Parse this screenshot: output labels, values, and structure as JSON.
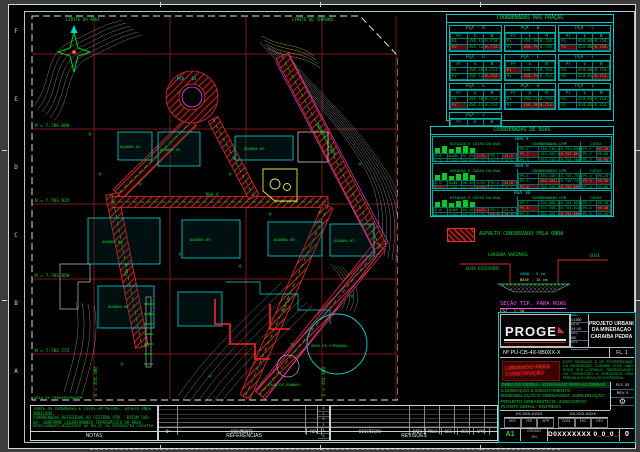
{
  "frame": {
    "row_letters": [
      "F",
      "E",
      "D",
      "C",
      "B",
      "A"
    ]
  },
  "map": {
    "labels": [
      {
        "t": "LIMITE DA ÁREA",
        "x": 36,
        "y": 7,
        "c": "#00dd33",
        "s": 4
      },
      {
        "t": "LIMITE DO TERRENO",
        "x": 262,
        "y": 7,
        "c": "#00dd33",
        "s": 4
      },
      {
        "t": "PÇA - 01",
        "x": 147,
        "y": 66,
        "c": "#00e0e0",
        "s": 4
      },
      {
        "t": "QUADRA 01",
        "x": 90,
        "y": 134,
        "c": "#00dd33",
        "s": 3.8
      },
      {
        "t": "QUADRA 02",
        "x": 130,
        "y": 137,
        "c": "#00dd33",
        "s": 3.8
      },
      {
        "t": "QUADRA 03",
        "x": 214,
        "y": 136,
        "c": "#00dd33",
        "s": 3.8
      },
      {
        "t": "QUADRA 04",
        "x": 72,
        "y": 229,
        "c": "#00dd33",
        "s": 3.8
      },
      {
        "t": "QUADRA 05",
        "x": 160,
        "y": 227,
        "c": "#00dd33",
        "s": 3.8
      },
      {
        "t": "QUADRA 06",
        "x": 244,
        "y": 227,
        "c": "#00dd33",
        "s": 3.8
      },
      {
        "t": "QUADRA 07",
        "x": 304,
        "y": 228,
        "c": "#00dd33",
        "s": 3.8
      },
      {
        "t": "QUADRA 08",
        "x": 78,
        "y": 294,
        "c": "#00dd33",
        "s": 3.8
      },
      {
        "t": "RUA 4",
        "x": 176,
        "y": 182,
        "c": "#00dd33",
        "s": 4
      },
      {
        "t": "RUA 6",
        "x": 97,
        "y": 262,
        "c": "#00dd33",
        "s": 4,
        "r": -83
      },
      {
        "t": "RUA 10",
        "x": 254,
        "y": 298,
        "c": "#00dd33",
        "s": 4,
        "r": -64
      },
      {
        "t": "ESTRADA DA MINA",
        "x": 286,
        "y": 110,
        "c": "#00dd33",
        "s": 4,
        "r": 60
      },
      {
        "t": "ÁREA DE EXPANSÃO",
        "x": 281,
        "y": 333,
        "c": "#00dd33",
        "s": 3.8
      },
      {
        "t": "CASA DE BOMBAS",
        "x": 238,
        "y": 372,
        "c": "#00dd33",
        "s": 3.8
      },
      {
        "t": "ÁREA DE TERRAPLENAGEM",
        "x": 4,
        "y": 385,
        "c": "#00dd33",
        "s": 3.8
      },
      {
        "t": "N = 7.784.000",
        "x": 5,
        "y": 113,
        "c": "#00dd33",
        "s": 4.4
      },
      {
        "t": "N = 7.783.925",
        "x": 5,
        "y": 188,
        "c": "#00dd33",
        "s": 4.4
      },
      {
        "t": "N = 7.783.850",
        "x": 5,
        "y": 263,
        "c": "#00dd33",
        "s": 4.4
      },
      {
        "t": "N = 7.783.775",
        "x": 5,
        "y": 338,
        "c": "#00dd33",
        "s": 4.4
      },
      {
        "t": "E = 354.100",
        "x": 67,
        "y": 382,
        "c": "#00dd33",
        "s": 4.4,
        "r": -90
      },
      {
        "t": "E = 354.400",
        "x": 295,
        "y": 382,
        "c": "#00dd33",
        "s": 4.4,
        "r": -90
      }
    ]
  },
  "praca_tables": {
    "title": "COORDENADAS DAS PRAÇAS",
    "col_headers": [
      "PT",
      "E",
      "N"
    ],
    "tables": [
      {
        "name": "PÇA - A",
        "rows": [
          [
            "P1",
            "354.712,40",
            "8.754.061,22"
          ],
          [
            "!P2",
            "354.728,15",
            "!8.754.048,90"
          ]
        ]
      },
      {
        "name": "PÇA - B",
        "rows": [
          [
            "P1",
            "354.780,55",
            "8.754.070,18"
          ],
          [
            "P2",
            "!354.795,02",
            "8.754.055,60"
          ]
        ]
      },
      {
        "name": "PÇA - C",
        "rows": [
          [
            "P1",
            "354.848,12",
            "8.754.066,45"
          ],
          [
            "!P2",
            "354.861,77",
            "!8.754.050,23"
          ]
        ]
      },
      {
        "name": "PÇA - D",
        "rows": [
          [
            "P1",
            "354.706,88",
            "8.753.988,35"
          ],
          [
            "P2",
            "354.721,40",
            "!8.753.974,10"
          ]
        ]
      },
      {
        "name": "PÇA - E",
        "rows": [
          [
            "!P1",
            "354.775,30",
            "8.753.992,72"
          ],
          [
            "P2",
            "!354.790,11",
            "8.753.977,48"
          ]
        ]
      },
      {
        "name": "PÇA - F",
        "rows": [
          [
            "P1",
            "354.843,95",
            "8.753.985,06"
          ],
          [
            "P2",
            "354.858,60",
            "!8.753.970,84"
          ]
        ]
      },
      {
        "name": "PÇA - G",
        "rows": [
          [
            "P1",
            "354.702,17",
            "8.753.910,58"
          ],
          [
            "!P2",
            "354.716,93",
            "8.753.896,30"
          ]
        ]
      },
      {
        "name": "PÇA - H",
        "rows": [
          [
            "P1",
            "354.770,44",
            "8.753.905,12"
          ],
          [
            "P2",
            "!354.785,20",
            "!8.753.890,77"
          ]
        ]
      },
      {
        "name": "PÇA - I",
        "rows": [
          [
            "P1",
            "354.838,66",
            "8.753.902,40"
          ],
          [
            "P2",
            "354.853,33",
            "8.753.888,15"
          ]
        ]
      },
      {
        "name": "PÇA - J",
        "rows": [
          [
            "P1",
            "354.698,25",
            "8.753.830,90"
          ],
          [
            "!P2",
            "354.712,84",
            "!8.753.816,55"
          ]
        ]
      }
    ]
  },
  "ruas_block": {
    "title": "COORDENADAS DE RUAS",
    "sections": [
      {
        "name": "RUA 4",
        "left_title": "ESTACAS E COTAS DA RUA",
        "mid_title": "COORDENADAS UTM",
        "right_title": "COTAS",
        "left_rows": [
          [
            "E-0",
            "0+00",
            "97,45",
            "!i=2%",
            "PV-1",
            "!12,5"
          ],
          [
            "E-1",
            "1+00",
            "96,80",
            "i=2%",
            "PV-2",
            "14,0"
          ]
        ],
        "mid_rows": [
          [
            "PV-1",
            "354.210,45",
            "8.753.850,12"
          ],
          [
            "!PV-2",
            "354.265,80",
            "!8.753.801,34"
          ],
          [
            "PV-3",
            "354.310,22",
            "8.753.760,90"
          ]
        ],
        "right_rows": [
          [
            "PV-1",
            "!97,45"
          ],
          [
            "PV-2",
            "96,80"
          ],
          [
            "PV-3",
            "!95,95"
          ]
        ]
      },
      {
        "name": "RUA 6",
        "left_title": "ESTACAS E COTAS DA RUA",
        "mid_title": "COORDENADAS UTM",
        "right_title": "COTAS",
        "left_rows": [
          [
            "E-0",
            "0+00",
            "96,20",
            "i=3%",
            "PV-4",
            "!11,0"
          ],
          [
            "!E-1",
            "1+00",
            "95,55",
            "!i=3%",
            "PV-5",
            "13,5"
          ]
        ],
        "mid_rows": [
          [
            "PV-4",
            "354.158,72",
            "8.753.792,60"
          ],
          [
            "PV-5",
            "!354.204,18",
            "8.753.744,05"
          ],
          [
            "!PV-6",
            "354.250,63",
            "!8.753.698,41"
          ]
        ],
        "right_rows": [
          [
            "PV-4",
            "96,20"
          ],
          [
            "!PV-5",
            "!95,55"
          ],
          [
            "PV-6",
            "94,80"
          ]
        ]
      },
      {
        "name": "RUA 10",
        "left_title": "ESTACAS E COTAS DA RUA",
        "mid_title": "COORDENADAS UTM",
        "right_title": "COTAS",
        "left_rows": [
          [
            "E-0",
            "0+00",
            "95,10",
            "!i=2%",
            "PV-7",
            "12,0"
          ],
          [
            "E-1",
            "1+00",
            "94,40",
            "i=2%",
            "!PV-8",
            "!10,5"
          ]
        ],
        "mid_rows": [
          [
            "PV-7",
            "354.302,90",
            "8.753.655,28"
          ],
          [
            "!PV-8",
            "354.348,35",
            "8.753.610,72"
          ],
          [
            "PV-9",
            "354.393,81",
            "!8.753.566,17"
          ]
        ],
        "right_rows": [
          [
            "PV-7",
            "95,10"
          ],
          [
            "PV-8",
            "!94,40"
          ],
          [
            "PV-9",
            "93,65"
          ]
        ]
      }
    ]
  },
  "legend": {
    "swatch_label": "ASFALTO CONSERVADO PELA OBRA"
  },
  "section_detail": {
    "title": "SEÇÃO TIP. PARA RUAS",
    "scale": "ESC. 1:20",
    "dim_top": "LARGURA VARIÁVEL",
    "lbl_left": "GUIA EXISTENTE",
    "lbl_right": "GUIA",
    "lbl_mid1": "CBUQ - 5 cm",
    "lbl_mid2": "BASE - 15 cm"
  },
  "title_block": {
    "logo": "PROGE",
    "logo_mark": "◣",
    "info_rows": [
      [
        "ESC.",
        "1:1000"
      ],
      [
        "DATA",
        "XX-XX"
      ],
      [
        "DES.",
        "MC"
      ],
      [
        "REV.",
        "0"
      ]
    ],
    "project_title_lines": [
      "PROJETO URBANÍSTICO",
      "DA MINERAÇÃO",
      "CARAÍBA PEDRA"
    ],
    "doc_number": "Nº  PU-CB-4X-0B0XX-X",
    "sheet_cell": "FL. 1",
    "stamp_text": "LIBERADO PARA CONSTRUÇÃO",
    "note_text": "ESTE DESENHO É DE PROPRIEDADE DA MINERAÇÃO CARAÍBA LTDA. NÃO PODE SER COPIADO, REPRODUZIDO OU FORNECIDO A TERCEIROS SEM PRÉVIA AUTORIZAÇÃO EXPRESSA.",
    "desc_lines": [
      "OBRA DE PEDRA - EXPANSÃO PARA AS OBRAS",
      "ILUMINAÇÃO E ESGOTAMENTO",
      "REMODELAÇÃO E DRENAGEM - EXPLORAÇÃO",
      "PROJETO URBANÍSTICO - EXECUTIVO",
      "PLANTA GERAL - ENTREGA"
    ],
    "side_rows": [
      "FLS. 03",
      "REV. 0"
    ],
    "gear_icon": "⚙",
    "stamp_cols": [
      {
        "label": "XX-XXX-XXXX",
        "cells": [
          "DES",
          "VER",
          "APR"
        ]
      },
      {
        "label": "XX-XXX-XXXX",
        "cells": [
          "DATA",
          "ESC",
          "REV"
        ]
      }
    ],
    "format": "A1",
    "code_top": "CÓDIGO",
    "code_bottom": "GH",
    "drawing_number": "D0XXXXXXX 0_0_0_1",
    "revision": "0"
  },
  "bottom": {
    "notas_header": "NOTAS",
    "notas_lines": [
      "TODAS AS DIMENSÕES E COTAS EM METROS, EXCETO ONDE INDICADO.",
      "COORDENADAS REFERIDAS AO SISTEMA UTM - DATUM SAD-69, CONFORME LEVANTAMENTO TOPOGRÁFICO DA ÁREA.",
      "NIVELAMENTO REFERIDO AO RN-01 DA MINERAÇÃO CARAÍBA (COTA 97,45 m).",
      "PAVIMENTAÇÃO DAS RUAS CONFORME SEÇÃO TIP."
    ],
    "ref_header": "REFERÊNCIAS",
    "ref_cols": [
      "Nº",
      "DOCUMENTO",
      "REV"
    ],
    "ref_index": [
      "5",
      "4",
      "3",
      "2",
      "1",
      "0"
    ],
    "rev_header": "REVISÕES",
    "rev_cols": [
      "DESCRIÇÃO",
      "DATA",
      "PROJ.",
      "DES.",
      "VER.",
      "APR."
    ]
  }
}
